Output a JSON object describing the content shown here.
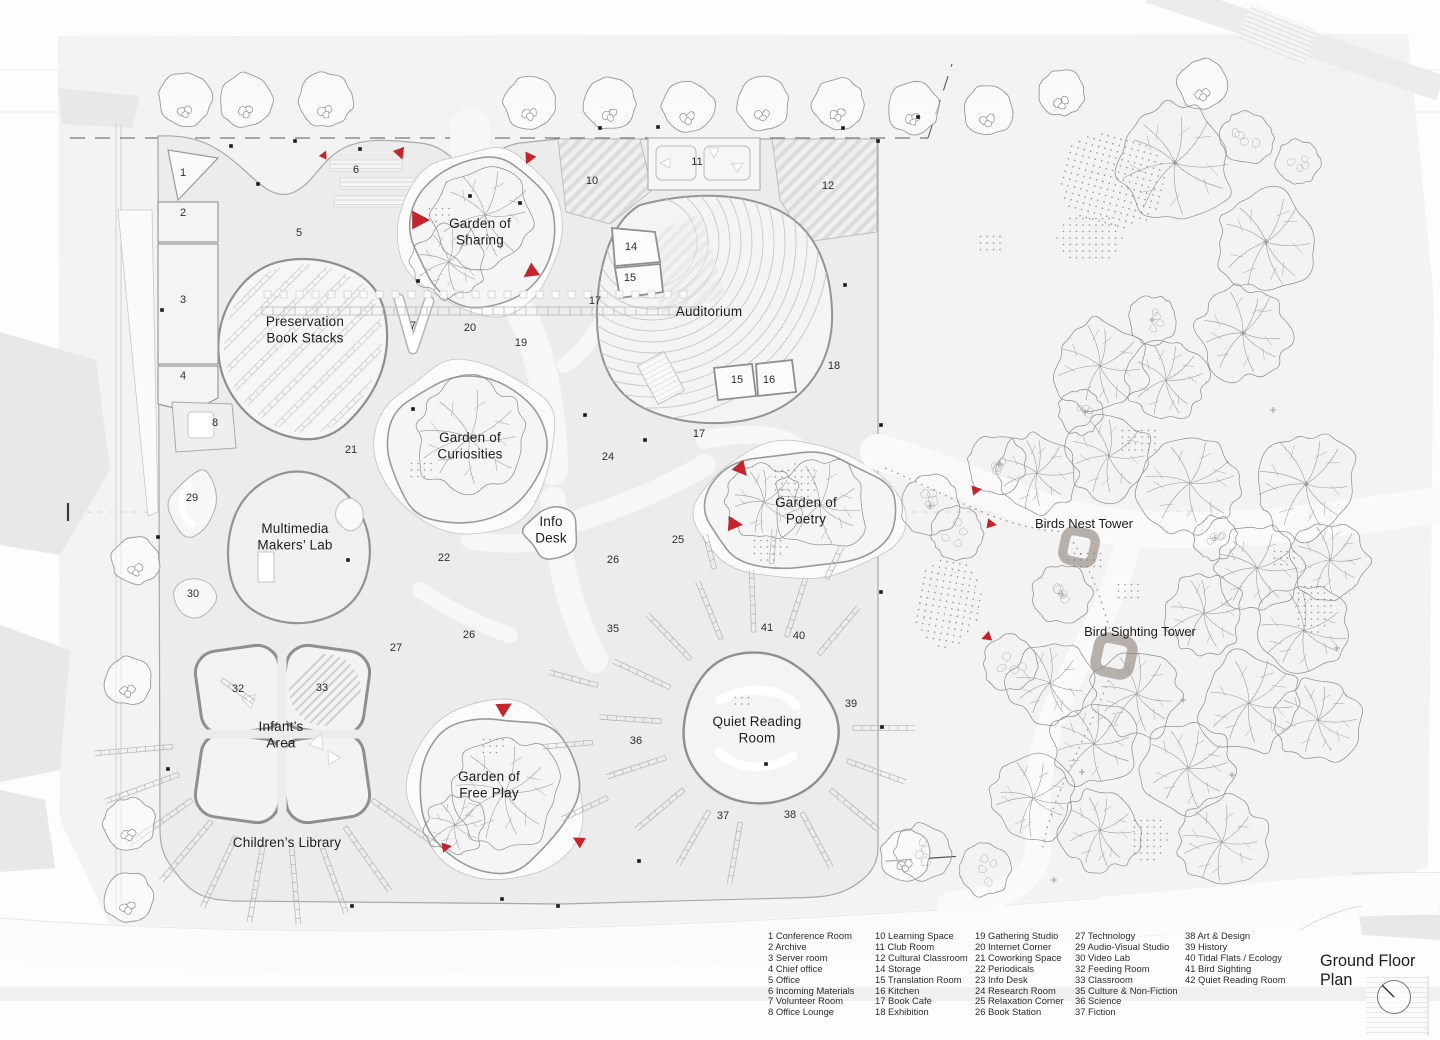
{
  "title": "Ground Floor Plan",
  "colors": {
    "red": "#c4242b",
    "ink": "#222222",
    "line": "#9b9b9b",
    "building_fill": "#ececec",
    "ground": "#f3f3f4",
    "tower_gray": "#b7afa9"
  },
  "area_labels": [
    {
      "name": "preservation-book-stacks",
      "text": "Preservation\nBook Stacks",
      "x": 305,
      "y": 326
    },
    {
      "name": "garden-of-sharing",
      "text": "Garden of\nSharing",
      "x": 480,
      "y": 228
    },
    {
      "name": "auditorium",
      "text": "Auditorium",
      "x": 709,
      "y": 316
    },
    {
      "name": "garden-of-curiosities",
      "text": "Garden of\nCuriosities",
      "x": 470,
      "y": 442
    },
    {
      "name": "multimedia-makers-lab",
      "text": "Multimedia\nMakers’ Lab",
      "x": 295,
      "y": 533
    },
    {
      "name": "info-desk",
      "text": "Info\nDesk",
      "x": 551,
      "y": 526
    },
    {
      "name": "garden-of-poetry",
      "text": "Garden of\nPoetry",
      "x": 806,
      "y": 507
    },
    {
      "name": "infants-area",
      "text": "Infant’s\nArea",
      "x": 281,
      "y": 731
    },
    {
      "name": "childrens-library",
      "text": "Children’s Library",
      "x": 287,
      "y": 847
    },
    {
      "name": "garden-of-free-play",
      "text": "Garden of\nFree Play",
      "x": 489,
      "y": 781
    },
    {
      "name": "quiet-reading-room",
      "text": "Quiet Reading\nRoom",
      "x": 757,
      "y": 726
    }
  ],
  "towers": [
    {
      "label": "Birds Nest Tower",
      "lx": 1084,
      "ly": 528,
      "x": 1079,
      "y": 547,
      "s": 15
    },
    {
      "label": "Bird Sighting Tower",
      "lx": 1140,
      "ly": 636,
      "x": 1114,
      "y": 656,
      "s": 17
    }
  ],
  "numbers": [
    [
      "1",
      183,
      176
    ],
    [
      "2",
      183,
      216
    ],
    [
      "3",
      183,
      303
    ],
    [
      "4",
      183,
      379
    ],
    [
      "5",
      299,
      236
    ],
    [
      "6",
      356,
      173
    ],
    [
      "7",
      413,
      329
    ],
    [
      "8",
      215,
      426
    ],
    [
      "10",
      592,
      184
    ],
    [
      "11",
      697,
      165
    ],
    [
      "12",
      828,
      189
    ],
    [
      "14",
      631,
      250
    ],
    [
      "15",
      630,
      281
    ],
    [
      "17",
      595,
      304
    ],
    [
      "20",
      470,
      331
    ],
    [
      "19",
      521,
      346
    ],
    [
      "18",
      834,
      369
    ],
    [
      "15",
      737,
      383
    ],
    [
      "16",
      769,
      383
    ],
    [
      "21",
      351,
      453
    ],
    [
      "17",
      699,
      437
    ],
    [
      "24",
      608,
      460
    ],
    [
      "22",
      444,
      561
    ],
    [
      "25",
      678,
      543
    ],
    [
      "26",
      613,
      563
    ],
    [
      "29",
      192,
      501
    ],
    [
      "30",
      193,
      597
    ],
    [
      "26",
      469,
      638
    ],
    [
      "27",
      396,
      651
    ],
    [
      "32",
      238,
      692
    ],
    [
      "33",
      322,
      691
    ],
    [
      "35",
      613,
      632
    ],
    [
      "41",
      767,
      631
    ],
    [
      "40",
      799,
      639
    ],
    [
      "36",
      636,
      744
    ],
    [
      "39",
      851,
      707
    ],
    [
      "37",
      723,
      819
    ],
    [
      "38",
      790,
      818
    ]
  ],
  "entrance_markers": [
    [
      324,
      155,
      25,
      5
    ],
    [
      400,
      153,
      160,
      7
    ],
    [
      529,
      158,
      205,
      7
    ],
    [
      419,
      220,
      90,
      11
    ],
    [
      531,
      272,
      235,
      9
    ],
    [
      741,
      469,
      140,
      9
    ],
    [
      734,
      524,
      95,
      9
    ],
    [
      976,
      490,
      80,
      6
    ],
    [
      991,
      524,
      100,
      6
    ],
    [
      987,
      637,
      250,
      6
    ],
    [
      504,
      708,
      60,
      9
    ],
    [
      446,
      847,
      80,
      6
    ],
    [
      579,
      841,
      300,
      7
    ]
  ],
  "boundary_dots": [
    [
      231,
      146
    ],
    [
      295,
      141
    ],
    [
      360,
      149
    ],
    [
      470,
      196
    ],
    [
      520,
      203
    ],
    [
      600,
      128
    ],
    [
      658,
      127
    ],
    [
      843,
      128
    ],
    [
      878,
      141
    ],
    [
      845,
      285
    ],
    [
      881,
      425
    ],
    [
      881,
      592
    ],
    [
      882,
      727
    ],
    [
      766,
      764
    ],
    [
      558,
      906
    ],
    [
      502,
      899
    ],
    [
      352,
      906
    ],
    [
      162,
      310
    ],
    [
      158,
      537
    ],
    [
      168,
      769
    ],
    [
      258,
      184
    ],
    [
      418,
      281
    ],
    [
      639,
      861
    ],
    [
      918,
      117
    ],
    [
      348,
      560
    ],
    [
      413,
      409
    ],
    [
      585,
      415
    ],
    [
      645,
      440
    ]
  ],
  "vegetation": {
    "street_trees": [
      [
        185,
        100,
        27
      ],
      [
        246,
        100,
        27
      ],
      [
        326,
        100,
        27
      ],
      [
        530,
        103,
        26
      ],
      [
        610,
        104,
        26
      ],
      [
        688,
        107,
        26
      ],
      [
        763,
        104,
        26
      ],
      [
        838,
        104,
        26
      ],
      [
        913,
        108,
        26
      ],
      [
        988,
        110,
        25
      ],
      [
        1062,
        93,
        23
      ],
      [
        1203,
        84,
        25
      ],
      [
        136,
        560,
        24
      ],
      [
        128,
        681,
        24
      ],
      [
        129,
        824,
        26
      ],
      [
        128,
        897,
        25
      ],
      [
        905,
        855,
        25
      ]
    ],
    "leafy_trees": [
      [
        1175,
        163,
        58
      ],
      [
        1266,
        242,
        50
      ],
      [
        1100,
        366,
        46
      ],
      [
        1166,
        380,
        40
      ],
      [
        1243,
        333,
        46
      ],
      [
        1037,
        473,
        40
      ],
      [
        1109,
        456,
        42
      ],
      [
        1190,
        483,
        50
      ],
      [
        1306,
        484,
        52
      ],
      [
        1257,
        568,
        44
      ],
      [
        1204,
        613,
        40
      ],
      [
        1304,
        630,
        46
      ],
      [
        1249,
        703,
        50
      ],
      [
        1137,
        694,
        44
      ],
      [
        1050,
        683,
        40
      ],
      [
        1094,
        744,
        42
      ],
      [
        1188,
        768,
        46
      ],
      [
        1033,
        798,
        42
      ],
      [
        1100,
        830,
        40
      ],
      [
        1222,
        842,
        44
      ],
      [
        1330,
        560,
        38
      ],
      [
        1318,
        720,
        42
      ],
      [
        485,
        215,
        50
      ],
      [
        449,
        262,
        36
      ],
      [
        470,
        438,
        56
      ],
      [
        820,
        505,
        46
      ],
      [
        764,
        502,
        36
      ],
      [
        505,
        792,
        54
      ],
      [
        455,
        825,
        30
      ]
    ],
    "fluffy_trees": [
      [
        930,
        505,
        30
      ],
      [
        957,
        533,
        26
      ],
      [
        996,
        464,
        29
      ],
      [
        1062,
        594,
        29
      ],
      [
        1010,
        663,
        27
      ],
      [
        923,
        852,
        28
      ],
      [
        984,
        870,
        26
      ],
      [
        1247,
        138,
        26
      ],
      [
        1298,
        162,
        22
      ],
      [
        1152,
        320,
        24
      ],
      [
        1080,
        412,
        22
      ],
      [
        1215,
        538,
        22
      ]
    ],
    "dot_patches": [
      [
        1113,
        180,
        55,
        48,
        15
      ],
      [
        1090,
        238,
        33,
        26,
        0
      ],
      [
        1138,
        440,
        22,
        16,
        0
      ],
      [
        1086,
        560,
        18,
        13,
        0
      ],
      [
        1128,
        590,
        16,
        12,
        0
      ],
      [
        948,
        602,
        34,
        46,
        10
      ],
      [
        1282,
        556,
        14,
        11,
        0
      ],
      [
        795,
        482,
        26,
        18,
        0
      ],
      [
        768,
        548,
        20,
        14,
        0
      ],
      [
        990,
        242,
        16,
        12,
        0
      ],
      [
        1312,
        608,
        20,
        28,
        0
      ],
      [
        1148,
        838,
        20,
        24,
        0
      ],
      [
        437,
        212,
        14,
        10,
        0
      ],
      [
        420,
        468,
        15,
        11,
        0
      ],
      [
        492,
        744,
        15,
        11,
        0
      ],
      [
        741,
        700,
        12,
        9,
        0
      ]
    ],
    "plus_marks": [
      [
        1000,
        464
      ],
      [
        1062,
        594
      ],
      [
        930,
        506
      ],
      [
        1175,
        163
      ],
      [
        1266,
        242
      ],
      [
        1306,
        484
      ],
      [
        1243,
        333
      ],
      [
        1152,
        320
      ],
      [
        1085,
        412
      ],
      [
        1215,
        538
      ],
      [
        1273,
        410
      ],
      [
        1337,
        648
      ],
      [
        1183,
        700
      ],
      [
        1082,
        772
      ],
      [
        1054,
        880
      ],
      [
        1232,
        775
      ]
    ]
  },
  "legend": {
    "col_x": [
      768,
      875,
      975,
      1075,
      1185
    ],
    "top": 931,
    "columns": [
      [
        [
          "1",
          "Conference Room"
        ],
        [
          "2",
          "Archive"
        ],
        [
          "3",
          "Server room"
        ],
        [
          "4",
          "Chief office"
        ],
        [
          "5",
          "Office"
        ],
        [
          "6",
          "Incoming Materials"
        ],
        [
          "7",
          "Volunteer Room"
        ],
        [
          "8",
          "Office Lounge"
        ]
      ],
      [
        [
          "10",
          "Learning Space"
        ],
        [
          "11",
          "Club Room"
        ],
        [
          "12",
          "Cultural Classroom"
        ],
        [
          "14",
          "Storage"
        ],
        [
          "15",
          "Translation Room"
        ],
        [
          "16",
          "Kitchen"
        ],
        [
          "17",
          "Book Cafe"
        ],
        [
          "18",
          "Exhibition"
        ]
      ],
      [
        [
          "19",
          "Gathering Studio"
        ],
        [
          "20",
          "Internet Corner"
        ],
        [
          "21",
          "Coworking Space"
        ],
        [
          "22",
          "Periodicals"
        ],
        [
          "23",
          "Info Desk"
        ],
        [
          "24",
          "Research Room"
        ],
        [
          "25",
          "Relaxation Corner"
        ],
        [
          "26",
          "Book Station"
        ]
      ],
      [
        [
          "27",
          "Technology"
        ],
        [
          "29",
          "Audio-Visual Studio"
        ],
        [
          "30",
          "Video Lab"
        ],
        [
          "32",
          "Feeding Room"
        ],
        [
          "33",
          "Classroom"
        ],
        [
          "35",
          "Culture & Non-Fiction"
        ],
        [
          "36",
          "Science"
        ],
        [
          "37",
          "Fiction"
        ]
      ],
      [
        [
          "38",
          "Art & Design"
        ],
        [
          "39",
          "History"
        ],
        [
          "40",
          "Tidal Flats / Ecology"
        ],
        [
          "41",
          "Bird Sighting"
        ],
        [
          "42",
          "Quiet Reading Room"
        ]
      ]
    ]
  }
}
